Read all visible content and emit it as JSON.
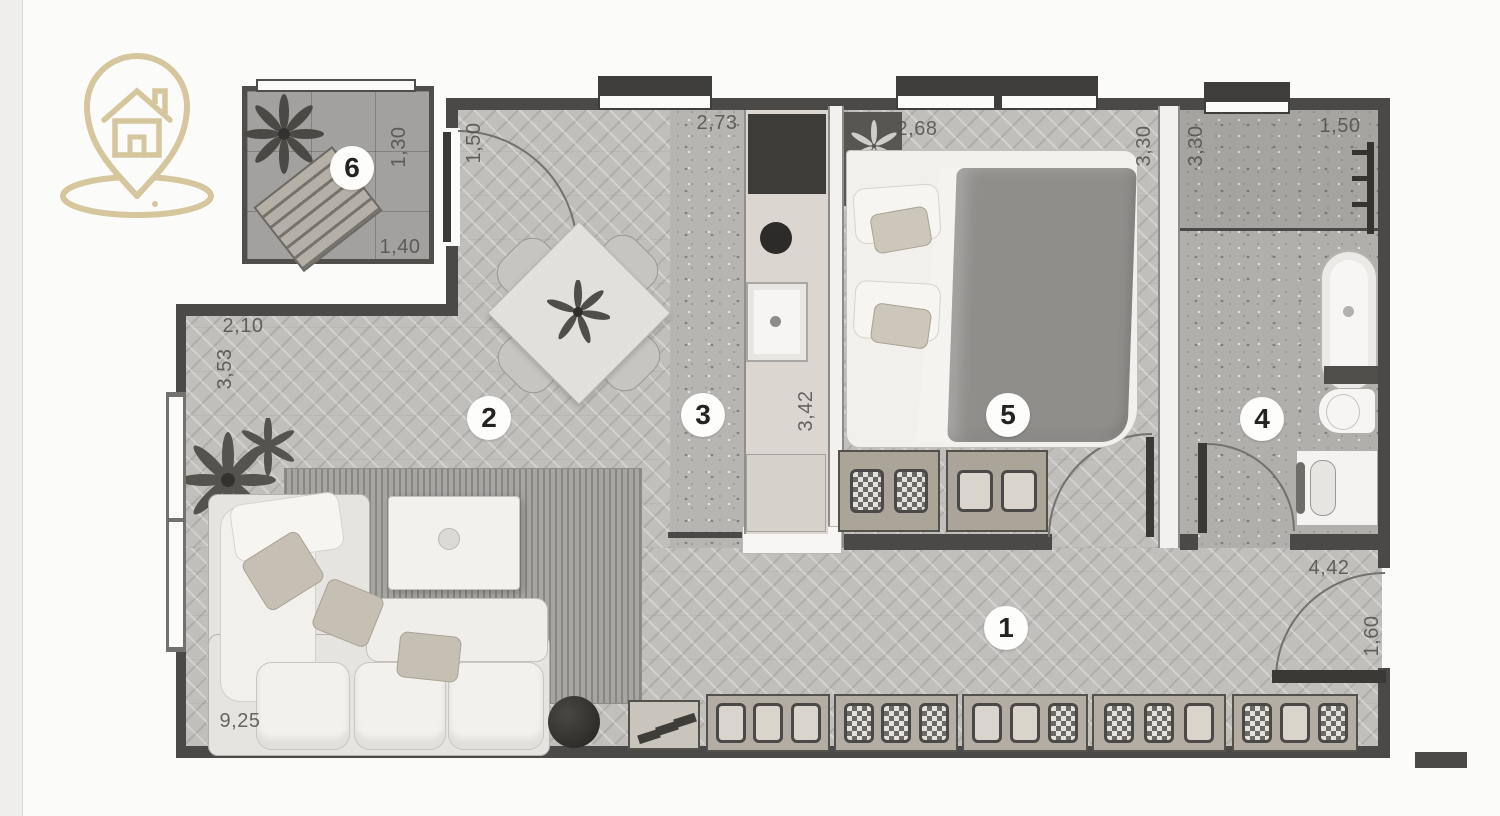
{
  "logo": {
    "icon": "house-location-pin-icon",
    "color": "#d5c69d"
  },
  "colors": {
    "wall": "#4a4947",
    "floor_wood": "#c0bfbc",
    "floor_stone": "#b1afac",
    "accent_gold": "#d5c69d",
    "background": "#fbfbfa"
  },
  "plan": {
    "room_markers": [
      {
        "number": "1"
      },
      {
        "number": "2"
      },
      {
        "number": "3"
      },
      {
        "number": "4"
      },
      {
        "number": "5"
      },
      {
        "number": "6"
      }
    ],
    "dimensions": [
      {
        "value": "1,50"
      },
      {
        "value": "2,73"
      },
      {
        "value": "2,68"
      },
      {
        "value": "3,30"
      },
      {
        "value": "3,30"
      },
      {
        "value": "1,50"
      },
      {
        "value": "1,30"
      },
      {
        "value": "1,40"
      },
      {
        "value": "2,10"
      },
      {
        "value": "3,53"
      },
      {
        "value": "3,42"
      },
      {
        "value": "4,42"
      },
      {
        "value": "1,60"
      },
      {
        "value": "9,25"
      }
    ]
  }
}
